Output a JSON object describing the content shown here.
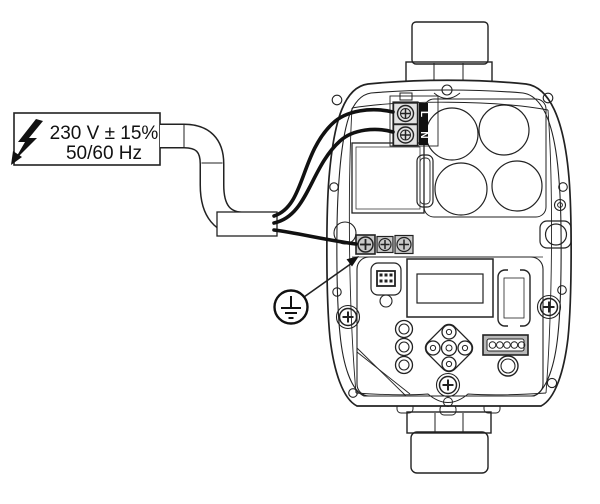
{
  "power_label": {
    "line1": "230 V ± 15%",
    "line2": "50/60 Hz"
  },
  "terminal_block": {
    "terminals": [
      {
        "label": "L",
        "name": "live"
      },
      {
        "label": "N",
        "name": "neutral"
      }
    ]
  },
  "icons": {
    "high_voltage": "high-voltage-bolt-icon",
    "protective_earth": "protective-earth-icon"
  },
  "colors": {
    "line": "#222222",
    "wire": "#111111",
    "strip_bg": "#111111",
    "strip_text": "#ffffff",
    "terminal_gray": "#c9c9c9",
    "connector_gray": "#b9b9b9",
    "background": "#ffffff"
  }
}
